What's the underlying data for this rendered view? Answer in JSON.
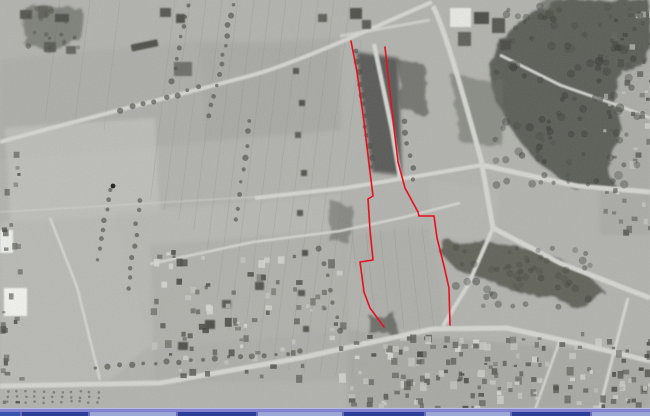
{
  "photo": {
    "kind": "grayscale-aerial-photograph",
    "content_summary": "Historical aerial photo: strip-field farmland left, dark wooded park with radiating road junction right, village street with dense houses along bottom",
    "base_tone": "#b2b2ae",
    "road_tone": "#d6d6d1",
    "forest_tone": "#53564e"
  },
  "annotation": {
    "outline_color": "#e8101f",
    "stroke_width": 1.6,
    "left_boundary": [
      [
        351,
        41
      ],
      [
        357,
        72
      ],
      [
        364,
        122
      ],
      [
        370,
        172
      ],
      [
        373,
        196
      ],
      [
        368,
        199
      ],
      [
        370,
        230
      ],
      [
        373,
        260
      ],
      [
        360,
        262
      ],
      [
        364,
        292
      ],
      [
        370,
        308
      ],
      [
        384,
        327
      ]
    ],
    "right_boundary": [
      [
        385,
        47
      ],
      [
        391,
        103
      ],
      [
        398,
        162
      ],
      [
        405,
        188
      ],
      [
        418,
        212
      ],
      [
        419,
        216
      ],
      [
        434,
        216
      ],
      [
        437,
        238
      ],
      [
        444,
        266
      ],
      [
        449,
        288
      ],
      [
        450,
        325
      ]
    ]
  },
  "taskbar": {
    "highlight_color": "#b8b8ea",
    "bar_color": "#8383cd",
    "divider_color": "#6b6bbd",
    "buttons": [
      {
        "width": 20,
        "color": "#3a55b0"
      },
      {
        "width": 66,
        "color": "#2e3f99"
      },
      {
        "width": 86,
        "color": "#9aa6d6"
      },
      {
        "width": 78,
        "color": "#2e3f99"
      },
      {
        "width": 84,
        "color": "#9aa6d6"
      },
      {
        "width": 80,
        "color": "#2e3f99"
      },
      {
        "width": 84,
        "color": "#9aa6d6"
      },
      {
        "width": 78,
        "color": "#2e3f99"
      },
      {
        "width": 74,
        "color": "#9aa6d6"
      }
    ]
  }
}
